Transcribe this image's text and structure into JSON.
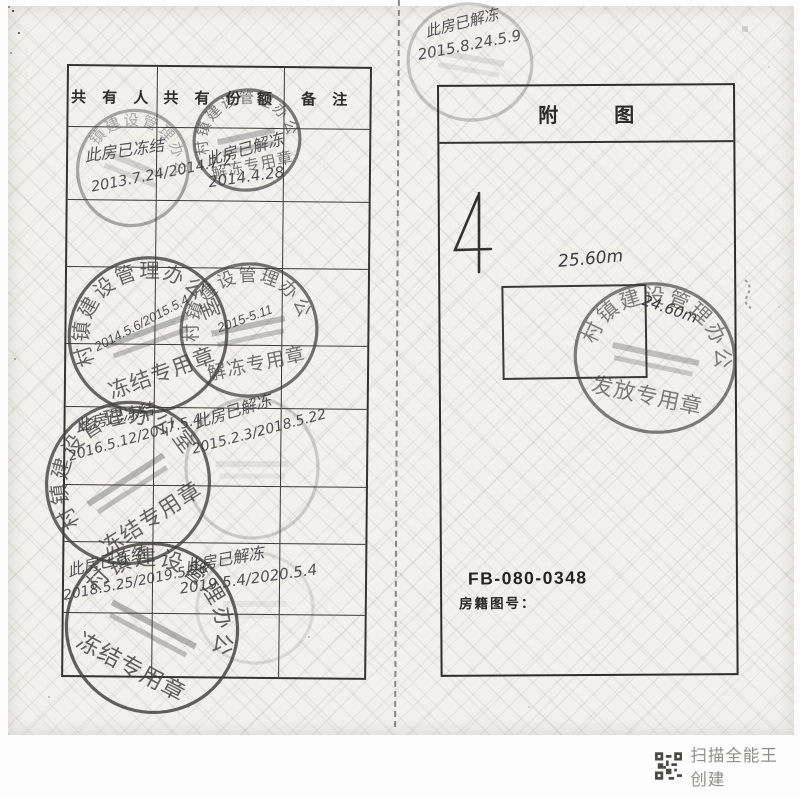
{
  "scan": {
    "left_page": {
      "table_headers": [
        "共 有 人",
        "共 有 份 额",
        "备  注"
      ],
      "notes": [
        {
          "line1": "此房已冻结",
          "line2": "2013.7.24/2014.7.2"
        },
        {
          "line1": "此房已解冻",
          "line2": "2014.4.28"
        },
        {
          "line1": "此房已冻结",
          "line2": "2016.5.12/2017.5.4"
        },
        {
          "line1": "此房已解冻",
          "line2": "2015.2.3/2018.5.22"
        },
        {
          "line1": "此房已冻结",
          "line2": "2018.5.25/2019.5.28"
        },
        {
          "line1": "此房已解冻",
          "line2": "2019.5.4/2020.5.4"
        }
      ]
    },
    "right_page": {
      "title": "附　图",
      "note": {
        "line1": "此房已解冻",
        "line2": "2015.8.24.5.9"
      },
      "dim_top": "25.60m",
      "dim_right": "24.60m",
      "figure_code": "FB-080-0348",
      "figure_label": "房籍图号："
    },
    "stamps": [
      {
        "id": "s1",
        "ring": "市村镇建设管理办公室",
        "bottom": "解冻专用章",
        "hand": ""
      },
      {
        "id": "s2",
        "ring": "村镇建设管理办公室",
        "bottom": "",
        "hand": ""
      },
      {
        "id": "s3",
        "ring": "村镇建设管理办公室",
        "bottom": "冻结专用章",
        "hand": "2014.5.6/2015.5.4"
      },
      {
        "id": "s4",
        "ring": "市村镇建设管理办公室",
        "bottom": "解冻专用章",
        "hand": "2015-5.11"
      },
      {
        "id": "s5",
        "ring": "村镇建设管理办公室",
        "bottom": "冻结专用章",
        "hand": ""
      },
      {
        "id": "s6",
        "ring": "",
        "bottom": "",
        "hand": ""
      },
      {
        "id": "s7",
        "ring": "市村镇建设管理办公室",
        "bottom": "冻结专用章",
        "hand": ""
      },
      {
        "id": "s8",
        "ring": "",
        "bottom": "",
        "hand": ""
      },
      {
        "id": "s9",
        "ring": "市村镇建设管理办公室",
        "bottom": "发放专用章",
        "hand": ""
      },
      {
        "id": "s10",
        "ring": "",
        "bottom": "",
        "hand": ""
      }
    ],
    "footer_watermark": "扫描全能王 创建"
  }
}
